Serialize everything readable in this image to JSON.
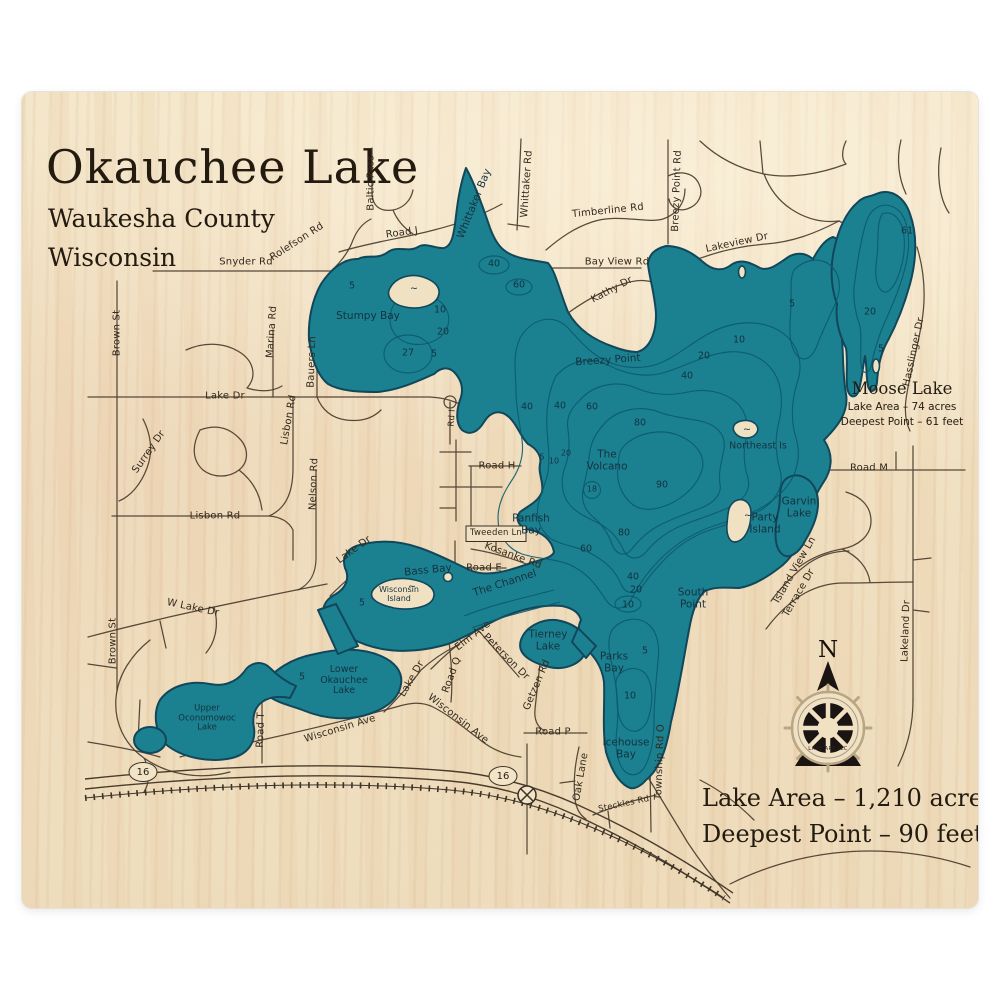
{
  "header": {
    "title": "Okauchee Lake",
    "county": "Waukesha County",
    "state": "Wisconsin"
  },
  "stats": {
    "area_label": "Lake Area – 1,210 acres",
    "depth_label": "Deepest Point – 90 feet"
  },
  "moose": {
    "name": "Moose Lake",
    "area_label": "Lake Area – 74 acres",
    "depth_label": "Deepest Point – 61 feet"
  },
  "compass": {
    "north_label": "N"
  },
  "logo": {
    "text": "LAKE ART LLC"
  },
  "colors": {
    "lake_fill": "#1b8191",
    "contour": "#0c5a6d",
    "shoreline": "#11475a",
    "wood": "#f0e1c3",
    "road": "#4a3c2c",
    "ink": "#231a10"
  },
  "map": {
    "highway_markers": [
      {
        "label": "16",
        "x": 143,
        "y": 772
      },
      {
        "label": "16",
        "x": 503,
        "y": 776
      }
    ],
    "labels": {
      "roads": [
        {
          "t": "Baltic Pass",
          "x": 371,
          "y": 183,
          "r": -90
        },
        {
          "t": "Road J",
          "x": 402,
          "y": 233,
          "r": -8
        },
        {
          "t": "Snyder Rd",
          "x": 246,
          "y": 262,
          "r": 0
        },
        {
          "t": "Rolefson Rd",
          "x": 297,
          "y": 242,
          "r": -33
        },
        {
          "t": "Whittaker Rd",
          "x": 527,
          "y": 184,
          "r": -86
        },
        {
          "t": "Timberline Rd",
          "x": 608,
          "y": 211,
          "r": -6
        },
        {
          "t": "Breezy Point Rd",
          "x": 677,
          "y": 191,
          "r": -88
        },
        {
          "t": "Lakeview Dr",
          "x": 737,
          "y": 243,
          "r": -12
        },
        {
          "t": "Bay View Rd",
          "x": 617,
          "y": 262,
          "r": 0
        },
        {
          "t": "Kathy Dr",
          "x": 612,
          "y": 290,
          "r": -28
        },
        {
          "t": "Hasslinger Dr",
          "x": 914,
          "y": 352,
          "r": -78
        },
        {
          "t": "Brown St",
          "x": 117,
          "y": 333,
          "r": -90
        },
        {
          "t": "Brown St",
          "x": 113,
          "y": 641,
          "r": -90
        },
        {
          "t": "Marina Rd",
          "x": 272,
          "y": 332,
          "r": -86
        },
        {
          "t": "Bauers Ln",
          "x": 312,
          "y": 362,
          "r": -88
        },
        {
          "t": "Lake Dr",
          "x": 225,
          "y": 396,
          "r": 0
        },
        {
          "t": "Lisbon Rd",
          "x": 289,
          "y": 420,
          "r": -80
        },
        {
          "t": "Surrey Dr",
          "x": 149,
          "y": 452,
          "r": -55
        },
        {
          "t": "Nelson Rd",
          "x": 314,
          "y": 484,
          "r": -88
        },
        {
          "t": "Lisbon Rd",
          "x": 215,
          "y": 516,
          "r": 0
        },
        {
          "t": "Road H",
          "x": 497,
          "y": 466,
          "r": 0
        },
        {
          "t": "Rd I",
          "x": 453,
          "y": 418,
          "r": -86,
          "s": 8.5
        },
        {
          "t": "Road M",
          "x": 869,
          "y": 468,
          "r": 0
        },
        {
          "t": "Tweeden Ln",
          "x": 496,
          "y": 534,
          "r": 0,
          "s": 8.5
        },
        {
          "t": "Kosanke Rd",
          "x": 513,
          "y": 556,
          "r": 20
        },
        {
          "t": "Road E",
          "x": 484,
          "y": 568,
          "r": 0
        },
        {
          "t": "Lake Dr",
          "x": 354,
          "y": 550,
          "r": -36
        },
        {
          "t": "W Lake Dr",
          "x": 193,
          "y": 608,
          "r": 12
        },
        {
          "t": "Elm Ave",
          "x": 473,
          "y": 636,
          "r": -38
        },
        {
          "t": "Road Q",
          "x": 452,
          "y": 675,
          "r": -70
        },
        {
          "t": "Peterson Dr",
          "x": 506,
          "y": 657,
          "r": 45
        },
        {
          "t": "Getzen Rd",
          "x": 537,
          "y": 685,
          "r": -67
        },
        {
          "t": "Wisconsin Ave",
          "x": 340,
          "y": 729,
          "r": -17
        },
        {
          "t": "Wisconsin Ave",
          "x": 458,
          "y": 719,
          "r": 38
        },
        {
          "t": "Road P",
          "x": 553,
          "y": 732,
          "r": 0
        },
        {
          "t": "Road T",
          "x": 261,
          "y": 730,
          "r": -88
        },
        {
          "t": "Lake Dr",
          "x": 412,
          "y": 679,
          "r": -60
        },
        {
          "t": "Oak Lane",
          "x": 581,
          "y": 777,
          "r": -80
        },
        {
          "t": "Township Rd O",
          "x": 660,
          "y": 762,
          "r": -88
        },
        {
          "t": "Steckles Rd",
          "x": 624,
          "y": 805,
          "r": -12,
          "s": 8.5
        },
        {
          "t": "Lakeland Dr",
          "x": 906,
          "y": 631,
          "r": -88
        },
        {
          "t": "Island View Ln",
          "x": 795,
          "y": 570,
          "r": -60
        },
        {
          "t": "Terrace Dr",
          "x": 799,
          "y": 593,
          "r": -60
        }
      ],
      "water": [
        {
          "t": "Whittaker Bay",
          "x": 475,
          "y": 204,
          "r": -68
        },
        {
          "t": "Stumpy Bay",
          "x": 368,
          "y": 317,
          "r": 0
        },
        {
          "t": "Breezy Point",
          "x": 608,
          "y": 361,
          "r": -4
        },
        {
          "t": "The\nVolcano",
          "x": 607,
          "y": 461,
          "r": 0
        },
        {
          "t": "Northeast Is",
          "x": 758,
          "y": 447,
          "r": 0,
          "s": 9.5
        },
        {
          "t": "Party\nIsland",
          "x": 765,
          "y": 524,
          "r": 0
        },
        {
          "t": "Panfish\nBay",
          "x": 531,
          "y": 525,
          "r": 0
        },
        {
          "t": "The Channel",
          "x": 505,
          "y": 584,
          "r": -18
        },
        {
          "t": "Bass Bay",
          "x": 428,
          "y": 571,
          "r": -6
        },
        {
          "t": "Wisconsin\nIsland",
          "x": 399,
          "y": 595,
          "r": 0,
          "s": 8
        },
        {
          "t": "South\nPoint",
          "x": 693,
          "y": 599,
          "r": 0
        },
        {
          "t": "Parks\nBay",
          "x": 614,
          "y": 663,
          "r": 0
        },
        {
          "t": "Icehouse\nBay",
          "x": 626,
          "y": 749,
          "r": 0
        },
        {
          "t": "Tierney\nLake",
          "x": 548,
          "y": 641,
          "r": 0
        },
        {
          "t": "Lower\nOkauchee\nLake",
          "x": 344,
          "y": 681,
          "r": 0,
          "s": 9.5
        },
        {
          "t": "Upper\nOconomowoc\nLake",
          "x": 207,
          "y": 719,
          "r": 0,
          "s": 8.5
        },
        {
          "t": "Garvin\nLake",
          "x": 799,
          "y": 508,
          "r": 0
        }
      ],
      "depths": [
        {
          "t": "5",
          "x": 352,
          "y": 287
        },
        {
          "t": "40",
          "x": 494,
          "y": 265
        },
        {
          "t": "60",
          "x": 519,
          "y": 286
        },
        {
          "t": "10",
          "x": 440,
          "y": 311
        },
        {
          "t": "20",
          "x": 443,
          "y": 333
        },
        {
          "t": "27",
          "x": 408,
          "y": 354
        },
        {
          "t": "5",
          "x": 434,
          "y": 355
        },
        {
          "t": "5",
          "x": 792,
          "y": 305
        },
        {
          "t": "10",
          "x": 739,
          "y": 341
        },
        {
          "t": "20",
          "x": 704,
          "y": 357
        },
        {
          "t": "40",
          "x": 687,
          "y": 377
        },
        {
          "t": "40",
          "x": 527,
          "y": 408
        },
        {
          "t": "40",
          "x": 560,
          "y": 407
        },
        {
          "t": "60",
          "x": 592,
          "y": 408
        },
        {
          "t": "80",
          "x": 640,
          "y": 424
        },
        {
          "t": "5",
          "x": 542,
          "y": 458,
          "s": 8
        },
        {
          "t": "10",
          "x": 554,
          "y": 462,
          "s": 8
        },
        {
          "t": "20",
          "x": 566,
          "y": 454,
          "s": 8
        },
        {
          "t": "18",
          "x": 592,
          "y": 490,
          "s": 8
        },
        {
          "t": "90",
          "x": 662,
          "y": 486
        },
        {
          "t": "80",
          "x": 624,
          "y": 534
        },
        {
          "t": "60",
          "x": 586,
          "y": 550
        },
        {
          "t": "40",
          "x": 633,
          "y": 578
        },
        {
          "t": "20",
          "x": 636,
          "y": 591
        },
        {
          "t": "10",
          "x": 628,
          "y": 606
        },
        {
          "t": "5",
          "x": 645,
          "y": 652
        },
        {
          "t": "10",
          "x": 630,
          "y": 697
        },
        {
          "t": "5",
          "x": 362,
          "y": 604
        },
        {
          "t": "5",
          "x": 302,
          "y": 678
        },
        {
          "t": "61",
          "x": 907,
          "y": 232
        },
        {
          "t": "20",
          "x": 870,
          "y": 313
        },
        {
          "t": "5",
          "x": 881,
          "y": 350
        },
        {
          "t": "~",
          "x": 414,
          "y": 290
        },
        {
          "t": "~",
          "x": 747,
          "y": 431
        },
        {
          "t": "~",
          "x": 748,
          "y": 517
        },
        {
          "t": "~",
          "x": 412,
          "y": 588
        }
      ]
    }
  }
}
